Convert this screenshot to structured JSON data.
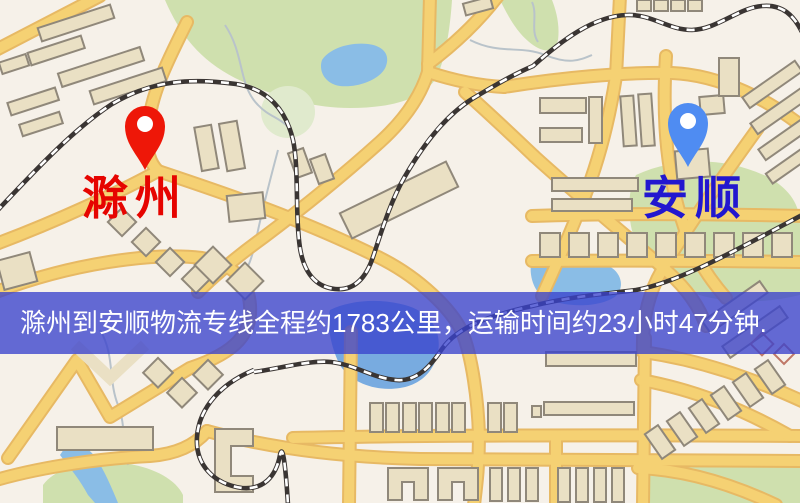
{
  "map": {
    "title": "滁州到安顺物流专线地图",
    "markers": [
      {
        "id": "origin",
        "name": "滁州",
        "pin": "red-location-pin"
      },
      {
        "id": "destination",
        "name": "安顺",
        "pin": "blue-location-pin"
      }
    ],
    "banner": {
      "text": "滁州到安顺物流专线全程约1783公里，运输时间约23小时47分钟."
    },
    "route": {
      "distance_km": "1783",
      "duration_hours": "23",
      "duration_minutes": "47"
    }
  },
  "colors": {
    "origin_pin": "#ee1708",
    "origin_label": "#e60400",
    "destination_pin": "#4f8cf2",
    "destination_label": "#2217cf",
    "banner_background": "rgba(58,66,205,0.78)",
    "banner_text": "#ffffff",
    "map_background": "#f6f1e9",
    "road": "#f5d173",
    "road_casing": "#e7b964",
    "building": "#eae0c4",
    "building_outline": "#90887a",
    "park": "#cfe0ae",
    "park_light": "#e0eacd",
    "water": "#8abde6",
    "water_dark": "#78abe0",
    "railway": "#3a3533",
    "railway_dash": "#ffffff",
    "stream": "#b9c3ca"
  }
}
